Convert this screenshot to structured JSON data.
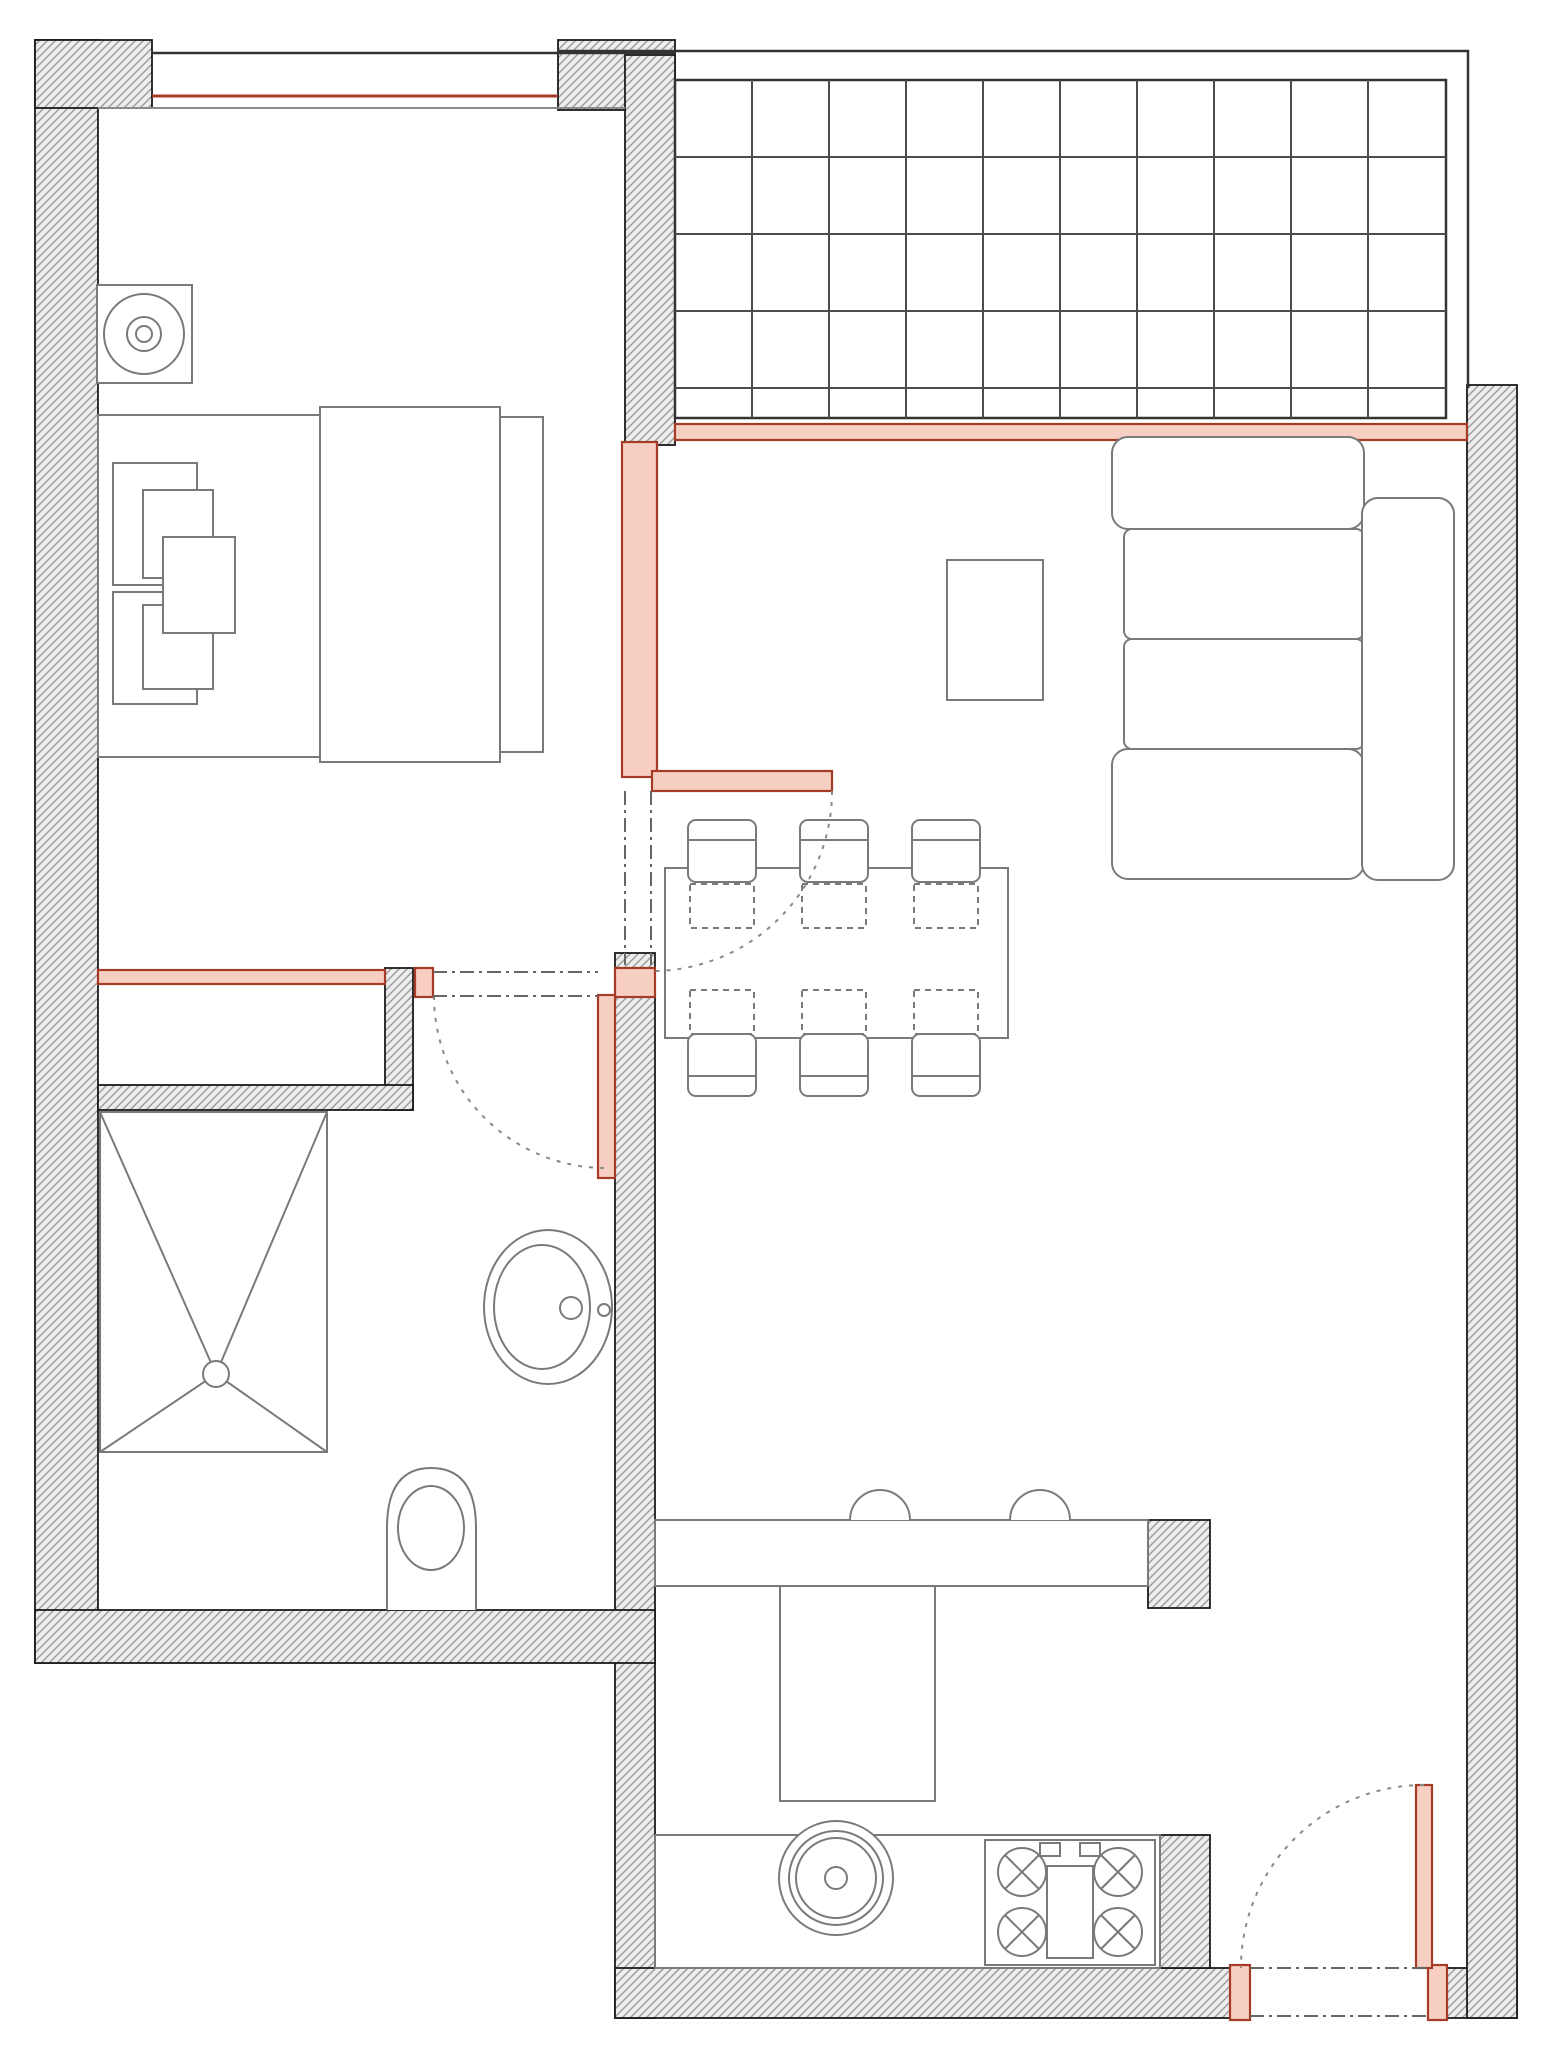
{
  "canvas": {
    "width": 1550,
    "height": 2066
  },
  "colors": {
    "wall_outline": "#1b1b1b",
    "hatch_line": "#9a9a9a",
    "hatch_bg": "#ededed",
    "furniture": "#7a7a7a",
    "red_accent": "#a63b28",
    "red_fill": "#f6cfc2",
    "dash": "#8a8a8a",
    "dashdot": "#666666",
    "grid_line": "#4c4c4c",
    "parapet": "#333333",
    "sill": "#8a8a8a"
  },
  "elements": [
    {
      "t": "hatch",
      "n": "wall-left",
      "x": 35,
      "y": 40,
      "w": 63,
      "h": 1623
    },
    {
      "t": "hatch",
      "n": "wall-top-left-segment",
      "x": 35,
      "y": 40,
      "w": 117,
      "h": 68
    },
    {
      "t": "hatch",
      "n": "wall-top-balcony-block",
      "x": 558,
      "y": 40,
      "w": 117,
      "h": 70
    },
    {
      "t": "hatch",
      "n": "wall-bedroom-balcony",
      "x": 625,
      "y": 55,
      "w": 50,
      "h": 390
    },
    {
      "t": "hatch",
      "n": "wall-closet-right",
      "x": 385,
      "y": 968,
      "w": 28,
      "h": 142
    },
    {
      "t": "hatch",
      "n": "wall-closet-bottom",
      "x": 98,
      "y": 1085,
      "w": 315,
      "h": 25
    },
    {
      "t": "hatch",
      "n": "wall-bathroom-kitchen",
      "x": 615,
      "y": 953,
      "w": 40,
      "h": 1065
    },
    {
      "t": "hatch",
      "n": "wall-bathroom-bottom",
      "x": 35,
      "y": 1610,
      "w": 620,
      "h": 53
    },
    {
      "t": "hatch",
      "n": "wall-bottom-left-of-entry",
      "x": 615,
      "y": 1968,
      "w": 615,
      "h": 50
    },
    {
      "t": "hatch",
      "n": "wall-bottom-right-corner",
      "x": 1428,
      "y": 1968,
      "w": 89,
      "h": 50
    },
    {
      "t": "hatch",
      "n": "wall-right",
      "x": 1467,
      "y": 385,
      "w": 50,
      "h": 1633
    },
    {
      "t": "hatch",
      "n": "wall-kitchen-stub-upper",
      "x": 1148,
      "y": 1520,
      "w": 62,
      "h": 88
    },
    {
      "t": "hatch",
      "n": "wall-kitchen-stub-lower",
      "x": 1160,
      "y": 1835,
      "w": 50,
      "h": 133
    },
    {
      "t": "line",
      "n": "window-top-outer-line",
      "x1": 152,
      "y1": 53,
      "x2": 675,
      "y2": 53,
      "s": "$parapet",
      "sw": 2.5
    },
    {
      "t": "line",
      "n": "window-top-sill-line",
      "x1": 98,
      "y1": 108,
      "x2": 625,
      "y2": 108,
      "s": "$sill",
      "sw": 2
    },
    {
      "t": "line",
      "n": "window-top-red-line",
      "x1": 152,
      "y1": 96,
      "x2": 558,
      "y2": 96,
      "s": "$red_accent",
      "sw": 3
    },
    {
      "t": "polyline",
      "n": "balcony-parapet",
      "pts": "558,51 1468,51 1468,388",
      "s": "$parapet",
      "sw": 2.5
    },
    {
      "t": "grid",
      "n": "balcony-tile-grid",
      "x": 675,
      "y": 80,
      "w": 771,
      "h": 338,
      "vx": [
        752,
        829,
        906,
        983,
        1060,
        1137,
        1214,
        1291,
        1368
      ],
      "hy": [
        157,
        234,
        311,
        388
      ],
      "s": "$grid_line",
      "sw": 2,
      "bs": "$parapet",
      "bsw": 2.5
    },
    {
      "t": "red",
      "n": "window-living-balcony",
      "x": 675,
      "y": 424,
      "w": 792,
      "h": 16
    },
    {
      "t": "red",
      "n": "new-wall-bedroom-living",
      "x": 622,
      "y": 442,
      "w": 35,
      "h": 335
    },
    {
      "t": "red",
      "n": "new-wall-bedroom-bottom",
      "x": 98,
      "y": 970,
      "w": 287,
      "h": 14
    },
    {
      "t": "red",
      "n": "bathroom-door-jamb",
      "x": 415,
      "y": 968,
      "w": 18,
      "h": 29
    },
    {
      "t": "red",
      "n": "bathroom-wall-red-cap",
      "x": 615,
      "y": 968,
      "w": 40,
      "h": 29
    },
    {
      "t": "rect",
      "n": "nightstand",
      "x": 97,
      "y": 285,
      "w": 95,
      "h": 98
    },
    {
      "t": "circle",
      "n": "lamp-outer-circle",
      "cx": 144,
      "cy": 334,
      "r": 40
    },
    {
      "t": "circle",
      "n": "lamp-mid-circle",
      "cx": 144,
      "cy": 334,
      "r": 17
    },
    {
      "t": "circle",
      "n": "lamp-inner-circle",
      "cx": 144,
      "cy": 334,
      "r": 8
    },
    {
      "t": "rect",
      "n": "bed-frame",
      "x": 98,
      "y": 415,
      "w": 402,
      "h": 342
    },
    {
      "t": "rect",
      "n": "bed-duvet",
      "x": 320,
      "y": 407,
      "w": 180,
      "h": 355
    },
    {
      "t": "rect",
      "n": "bed-blanket-edge",
      "x": 500,
      "y": 417,
      "w": 43,
      "h": 335
    },
    {
      "t": "rect",
      "n": "pillow-1",
      "x": 113,
      "y": 463,
      "w": 84,
      "h": 122
    },
    {
      "t": "rect",
      "n": "pillow-2",
      "x": 143,
      "y": 490,
      "w": 70,
      "h": 88
    },
    {
      "t": "rect",
      "n": "pillow-3",
      "x": 113,
      "y": 592,
      "w": 84,
      "h": 112
    },
    {
      "t": "rect",
      "n": "pillow-4",
      "x": 143,
      "y": 605,
      "w": 70,
      "h": 84
    },
    {
      "t": "rect",
      "n": "pillow-center",
      "x": 163,
      "y": 537,
      "w": 72,
      "h": 96
    },
    {
      "t": "rect",
      "n": "sofa-arm-top",
      "x": 1112,
      "y": 437,
      "w": 252,
      "h": 92,
      "rx": 16
    },
    {
      "t": "rect",
      "n": "sofa-seat-1",
      "x": 1124,
      "y": 529,
      "w": 240,
      "h": 110,
      "rx": 8
    },
    {
      "t": "rect",
      "n": "sofa-seat-2",
      "x": 1124,
      "y": 639,
      "w": 240,
      "h": 110,
      "rx": 8
    },
    {
      "t": "rect",
      "n": "sofa-arm-bottom",
      "x": 1112,
      "y": 749,
      "w": 252,
      "h": 130,
      "rx": 16
    },
    {
      "t": "rect",
      "n": "sofa-backrest",
      "x": 1362,
      "y": 498,
      "w": 92,
      "h": 382,
      "rx": 16
    },
    {
      "t": "rect",
      "n": "coffee-table",
      "x": 947,
      "y": 560,
      "w": 96,
      "h": 140
    },
    {
      "t": "rect",
      "n": "dining-table",
      "x": 665,
      "y": 868,
      "w": 343,
      "h": 170
    },
    {
      "t": "rect",
      "n": "chair-top-1",
      "x": 688,
      "y": 820,
      "w": 68,
      "h": 62,
      "rx": 8
    },
    {
      "t": "line",
      "n": "chair-top-1-backrest",
      "x1": 688,
      "y1": 840,
      "x2": 756,
      "y2": 840,
      "s": "$furniture",
      "sw": 2
    },
    {
      "t": "rect",
      "n": "chair-top-2",
      "x": 800,
      "y": 820,
      "w": 68,
      "h": 62,
      "rx": 8
    },
    {
      "t": "line",
      "n": "chair-top-2-backrest",
      "x1": 800,
      "y1": 840,
      "x2": 868,
      "y2": 840,
      "s": "$furniture",
      "sw": 2
    },
    {
      "t": "rect",
      "n": "chair-top-3",
      "x": 912,
      "y": 820,
      "w": 68,
      "h": 62,
      "rx": 8
    },
    {
      "t": "line",
      "n": "chair-top-3-backrest",
      "x1": 912,
      "y1": 840,
      "x2": 980,
      "y2": 840,
      "s": "$furniture",
      "sw": 2
    },
    {
      "t": "rect",
      "n": "chair-under-table-top-1",
      "x": 690,
      "y": 884,
      "w": 64,
      "h": 44,
      "dash": "6 5",
      "f": "none"
    },
    {
      "t": "rect",
      "n": "chair-under-table-top-2",
      "x": 802,
      "y": 884,
      "w": 64,
      "h": 44,
      "dash": "6 5",
      "f": "none"
    },
    {
      "t": "rect",
      "n": "chair-under-table-top-3",
      "x": 914,
      "y": 884,
      "w": 64,
      "h": 44,
      "dash": "6 5",
      "f": "none"
    },
    {
      "t": "rect",
      "n": "chair-under-table-bottom-1",
      "x": 690,
      "y": 990,
      "w": 64,
      "h": 44,
      "dash": "6 5",
      "f": "none"
    },
    {
      "t": "rect",
      "n": "chair-under-table-bottom-2",
      "x": 802,
      "y": 990,
      "w": 64,
      "h": 44,
      "dash": "6 5",
      "f": "none"
    },
    {
      "t": "rect",
      "n": "chair-under-table-bottom-3",
      "x": 914,
      "y": 990,
      "w": 64,
      "h": 44,
      "dash": "6 5",
      "f": "none"
    },
    {
      "t": "rect",
      "n": "chair-bottom-1",
      "x": 688,
      "y": 1034,
      "w": 68,
      "h": 62,
      "rx": 8
    },
    {
      "t": "line",
      "n": "chair-bottom-1-backrest",
      "x1": 688,
      "y1": 1076,
      "x2": 756,
      "y2": 1076,
      "s": "$furniture",
      "sw": 2
    },
    {
      "t": "rect",
      "n": "chair-bottom-2",
      "x": 800,
      "y": 1034,
      "w": 68,
      "h": 62,
      "rx": 8
    },
    {
      "t": "line",
      "n": "chair-bottom-2-backrest",
      "x1": 800,
      "y1": 1076,
      "x2": 868,
      "y2": 1076,
      "s": "$furniture",
      "sw": 2
    },
    {
      "t": "rect",
      "n": "chair-bottom-3",
      "x": 912,
      "y": 1034,
      "w": 68,
      "h": 62,
      "rx": 8
    },
    {
      "t": "line",
      "n": "chair-bottom-3-backrest",
      "x1": 912,
      "y1": 1076,
      "x2": 980,
      "y2": 1076,
      "s": "$furniture",
      "sw": 2
    },
    {
      "t": "rect",
      "n": "shower-tray",
      "x": 100,
      "y": 1112,
      "w": 227,
      "h": 340
    },
    {
      "t": "line",
      "n": "shower-diagonal-1",
      "x1": 100,
      "y1": 1112,
      "x2": 216,
      "y2": 1374,
      "s": "$furniture",
      "sw": 2
    },
    {
      "t": "line",
      "n": "shower-diagonal-2",
      "x1": 327,
      "y1": 1112,
      "x2": 216,
      "y2": 1374,
      "s": "$furniture",
      "sw": 2
    },
    {
      "t": "line",
      "n": "shower-diagonal-3",
      "x1": 100,
      "y1": 1452,
      "x2": 216,
      "y2": 1374,
      "s": "$furniture",
      "sw": 2
    },
    {
      "t": "line",
      "n": "shower-diagonal-4",
      "x1": 327,
      "y1": 1452,
      "x2": 216,
      "y2": 1374,
      "s": "$furniture",
      "sw": 2
    },
    {
      "t": "circle",
      "n": "shower-drain",
      "cx": 216,
      "cy": 1374,
      "r": 13
    },
    {
      "t": "ellipse",
      "n": "washbasin-outer",
      "cx": 548,
      "cy": 1307,
      "rx": 64,
      "ry": 77
    },
    {
      "t": "ellipse",
      "n": "washbasin-inner",
      "cx": 542,
      "cy": 1307,
      "rx": 48,
      "ry": 62
    },
    {
      "t": "circle",
      "n": "washbasin-faucet",
      "cx": 571,
      "cy": 1308,
      "r": 11
    },
    {
      "t": "circle",
      "n": "washbasin-tap-dot",
      "cx": 604,
      "cy": 1310,
      "r": 6
    },
    {
      "t": "path",
      "n": "toilet-body",
      "d": "M 387 1610 L 387 1528 Q 387 1468 431 1468 Q 476 1468 476 1528 L 476 1610",
      "f": "#ffffff"
    },
    {
      "t": "ellipse",
      "n": "toilet-bowl",
      "cx": 431,
      "cy": 1528,
      "rx": 33,
      "ry": 42
    },
    {
      "t": "rect",
      "n": "kitchen-peninsula-counter",
      "x": 655,
      "y": 1520,
      "w": 493,
      "h": 66
    },
    {
      "t": "rect",
      "n": "kitchen-counter-return",
      "x": 780,
      "y": 1586,
      "w": 155,
      "h": 215
    },
    {
      "t": "rect",
      "n": "kitchen-bottom-counter",
      "x": 655,
      "y": 1835,
      "w": 505,
      "h": 133
    },
    {
      "t": "path",
      "n": "barstool-1",
      "d": "M 850 1520 A 30 30 0 0 1 910 1520",
      "f": "#ffffff"
    },
    {
      "t": "path",
      "n": "barstool-2",
      "d": "M 1010 1520 A 30 30 0 0 1 1070 1520",
      "f": "#ffffff"
    },
    {
      "t": "circle",
      "n": "kitchen-sink-outer",
      "cx": 836,
      "cy": 1878,
      "r": 57
    },
    {
      "t": "circle",
      "n": "kitchen-sink-ring",
      "cx": 836,
      "cy": 1878,
      "r": 47
    },
    {
      "t": "circle",
      "n": "kitchen-sink-basin",
      "cx": 836,
      "cy": 1878,
      "r": 40
    },
    {
      "t": "circle",
      "n": "kitchen-sink-drain",
      "cx": 836,
      "cy": 1878,
      "r": 11
    },
    {
      "t": "rect",
      "n": "stove",
      "x": 985,
      "y": 1840,
      "w": 170,
      "h": 125
    },
    {
      "t": "burner",
      "n": "stove-burner-1",
      "cx": 1022,
      "cy": 1872,
      "r": 24
    },
    {
      "t": "burner",
      "n": "stove-burner-2",
      "cx": 1118,
      "cy": 1872,
      "r": 24
    },
    {
      "t": "burner",
      "n": "stove-burner-3",
      "cx": 1022,
      "cy": 1932,
      "r": 24
    },
    {
      "t": "burner",
      "n": "stove-burner-4",
      "cx": 1118,
      "cy": 1932,
      "r": 24
    },
    {
      "t": "rect",
      "n": "stove-center-panel",
      "x": 1047,
      "y": 1866,
      "w": 46,
      "h": 92
    },
    {
      "t": "rect",
      "n": "stove-knob-1",
      "x": 1040,
      "y": 1843,
      "w": 20,
      "h": 13
    },
    {
      "t": "rect",
      "n": "stove-knob-2",
      "x": 1080,
      "y": 1843,
      "w": 20,
      "h": 13
    },
    {
      "t": "red",
      "n": "bedroom-door-leaf",
      "x": 652,
      "y": 771,
      "w": 180,
      "h": 20
    },
    {
      "t": "red",
      "n": "bathroom-door-leaf",
      "x": 598,
      "y": 995,
      "w": 17,
      "h": 183
    },
    {
      "t": "red",
      "n": "entry-door-jamb-left",
      "x": 1230,
      "y": 1965,
      "w": 20,
      "h": 55
    },
    {
      "t": "red",
      "n": "entry-door-jamb-right",
      "x": 1428,
      "y": 1965,
      "w": 19,
      "h": 55
    },
    {
      "t": "red",
      "n": "entry-door-leaf",
      "x": 1416,
      "y": 1785,
      "w": 16,
      "h": 183
    },
    {
      "t": "path",
      "n": "bedroom-door-swing-arc",
      "d": "M 832 791 A 180 180 0 0 1 652 971",
      "s": "$dash",
      "sw": 2,
      "dash": "4 7",
      "f": "none"
    },
    {
      "t": "path",
      "n": "bathroom-door-swing-arc",
      "d": "M 434 996 A 172 172 0 0 0 606 1168",
      "s": "$dash",
      "sw": 2,
      "dash": "4 7",
      "f": "none"
    },
    {
      "t": "path",
      "n": "entry-door-swing-arc",
      "d": "M 1424 1785 A 183 183 0 0 0 1241 1968",
      "s": "$dash",
      "sw": 2,
      "dash": "4 7",
      "f": "none"
    },
    {
      "t": "line",
      "n": "opening-dashline-hall-left",
      "x1": 625,
      "y1": 791,
      "x2": 625,
      "y2": 965,
      "s": "$dashdot",
      "sw": 2,
      "dash": "14 5 3 5"
    },
    {
      "t": "line",
      "n": "opening-dashline-hall-right",
      "x1": 651,
      "y1": 791,
      "x2": 651,
      "y2": 965,
      "s": "$dashdot",
      "sw": 2,
      "dash": "14 5 3 5"
    },
    {
      "t": "line",
      "n": "opening-dashline-bath-top",
      "x1": 433,
      "y1": 972,
      "x2": 598,
      "y2": 972,
      "s": "$dashdot",
      "sw": 2,
      "dash": "14 5 3 5"
    },
    {
      "t": "line",
      "n": "opening-dashline-bath-bottom",
      "x1": 433,
      "y1": 996,
      "x2": 598,
      "y2": 996,
      "s": "$dashdot",
      "sw": 2,
      "dash": "14 5 3 5"
    },
    {
      "t": "line",
      "n": "opening-dashline-entry-top",
      "x1": 1250,
      "y1": 1968,
      "x2": 1428,
      "y2": 1968,
      "s": "$dashdot",
      "sw": 2,
      "dash": "14 5 3 5"
    },
    {
      "t": "line",
      "n": "opening-dashline-entry-bottom",
      "x1": 1250,
      "y1": 2016,
      "x2": 1428,
      "y2": 2016,
      "s": "$dashdot",
      "sw": 2,
      "dash": "14 5 3 5"
    }
  ]
}
